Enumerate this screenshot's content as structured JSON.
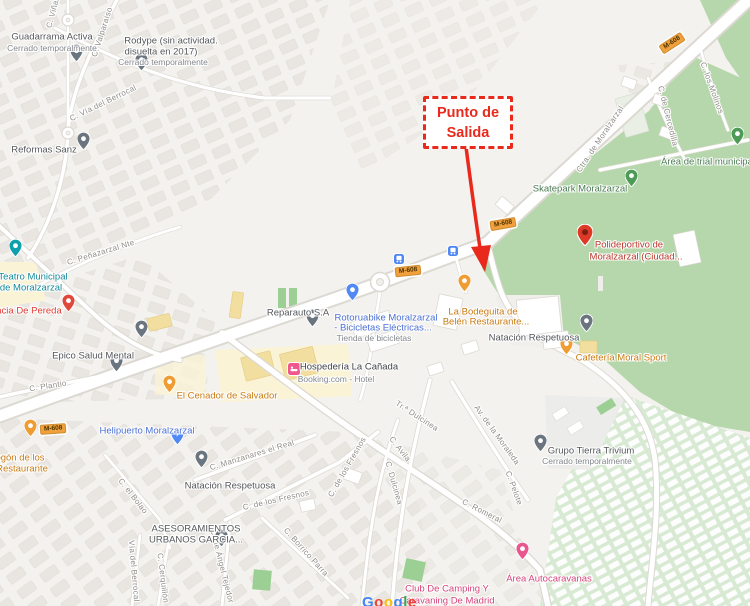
{
  "map": {
    "annotation": {
      "line1": "Punto de",
      "line2": "Salida"
    },
    "badges": [
      "M-608",
      "M-608",
      "M-608",
      "M-608"
    ],
    "streets": [
      "C. Viñas",
      "C. Valparaíso",
      "C. Vía del Berrocal",
      "C. Peñazarzal Nte.",
      "C. Plantio",
      "Ctra. de Moralzarzal",
      "C. los Molinos",
      "C. de Cercedilla",
      "C. Manzanares el Real",
      "C. de los Fresnos",
      "C. de los Fresnos",
      "C. el Bolao",
      "Vía del Berrocal",
      "C. Cerquillón",
      "C. de Ángel Tejedor",
      "C. Borrico Parra",
      "Tr.ª Dulcinea",
      "C. Avila",
      "C. Dulcinea",
      "Av. de la Moraleda",
      "C. Pelote",
      "C. Romeral"
    ],
    "pois": [
      {
        "name": "Guadarrama Activa",
        "sub": "Cerrado temporalmente"
      },
      {
        "l1": "Rodype (sin actividad.",
        "l2": "disuelta en 2017)",
        "sub": "Cerrado temporalmente"
      },
      {
        "name": "Reformas Sanz"
      },
      {
        "l1": "Teatro Municipal",
        "l2": "de Moralzarzal"
      },
      {
        "name": "acia De Pereda"
      },
      {
        "name": "Epico Salud Mental"
      },
      {
        "name": "Reparauto S.A"
      },
      {
        "l1": "Rotoruabike Moralzarzal",
        "l2": "- Bicicletas Eléctricas...",
        "sub": "Tienda de bicicletas"
      },
      {
        "l1": "La Bodeguita de",
        "l2": "Belén Restaurante..."
      },
      {
        "name": "Natación Respetuosa"
      },
      {
        "name": "Cafetería Moral Sport"
      },
      {
        "l1": "Polideportivo de",
        "l2": "Moralzarzal (Ciudad..."
      },
      {
        "name": "Skatepark Moralzarzal"
      },
      {
        "name": "Área de trial municipal"
      },
      {
        "name": "Hospedería La Cañada",
        "sub": "Booking.com - Hotel"
      },
      {
        "name": "El Cenador de Salvador"
      },
      {
        "name": "Helipuerto Moralzarzal"
      },
      {
        "name": "Natación Respetuosa"
      },
      {
        "l1": "ASESORAMIENTOS",
        "l2": "URBANOS GARCIA..."
      },
      {
        "name": "Grupo Tierra Trivium",
        "sub": "Cerrado temporalmente"
      },
      {
        "name": "Área Autocaravanas"
      },
      {
        "l1": "Club De Camping Y",
        "l2": "Caravaning De Madrid"
      },
      {
        "l1": "ogón de los",
        "l2": "Restaurante"
      }
    ],
    "google": [
      "G",
      "o",
      "o",
      "g",
      "l",
      "e"
    ],
    "colors": {
      "annotation_red": "#e8291c",
      "badge_orange": "#f0a13e",
      "poi_orange": "#c97a10",
      "poi_green": "#4a7b52",
      "poi_teal": "#128a99",
      "poi_blue": "#4a6fd3",
      "poi_red": "#ba362a",
      "poi_pink": "#d5437a",
      "poi_gray": "#54575b",
      "street_gray": "#8f8d88",
      "park_green": "#b5d7ab",
      "camping_green": "#d8ead3"
    }
  }
}
